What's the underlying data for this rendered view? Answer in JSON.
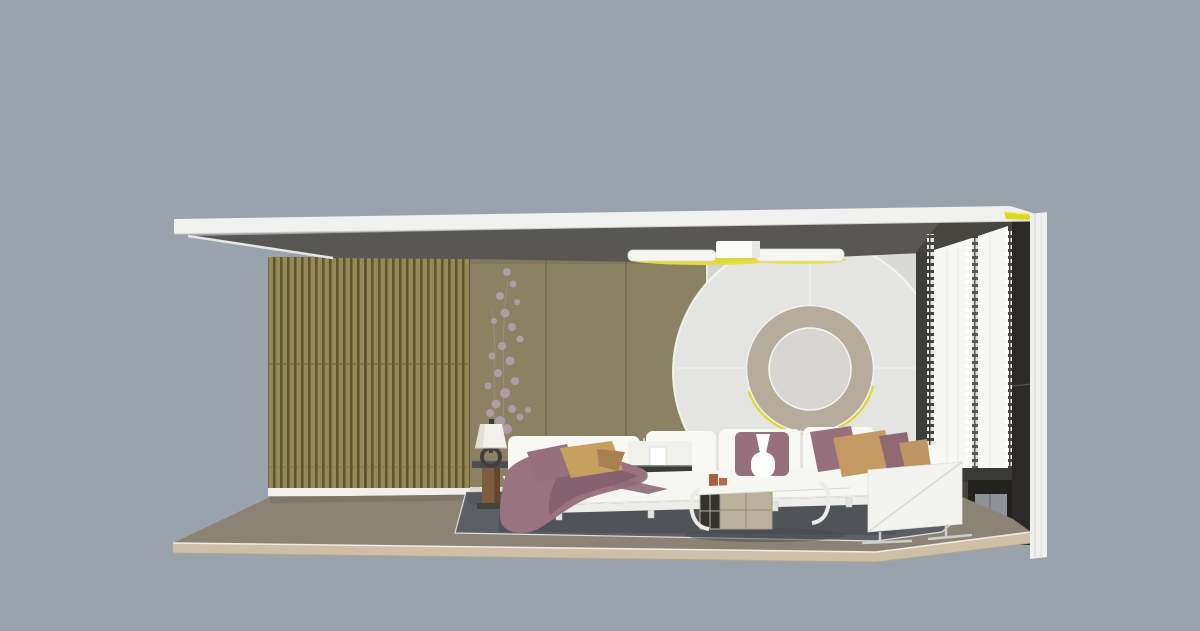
{
  "scene": {
    "title": "3D interior render - living room section cutaway",
    "background": "#9AA2AC",
    "objects": [
      "roof-slab",
      "ceiling-plane",
      "slat-wall",
      "panel-wall",
      "white-wall",
      "circle-feature-wall",
      "ring-niche",
      "ceiling-light",
      "sheer-curtains",
      "dark-window-wall",
      "window-glass",
      "right-frame",
      "floor-slab",
      "rug",
      "sectional-sofa",
      "throw-blanket",
      "pillows",
      "table-lamp",
      "side-table",
      "blossom-plant",
      "coffee-table",
      "storage-boxes",
      "media-cabinet"
    ]
  },
  "colors": {
    "background": "#9AA2AC",
    "roof": "#F1F1EF",
    "roof_accent_yellow": "#D8D922",
    "ceiling": "#585753",
    "slat_light": "#948A57",
    "slat_dark": "#5E5631",
    "panel_wall": "#8B8263",
    "white_wall": "#DADAD7",
    "disc": "#E4E4E2",
    "ring": "#B5AC9C",
    "ring_inner": "#D7D6D2",
    "ring_glow": "#DDD72E",
    "light_glow": "#E4DF39",
    "light_body": "#F5F5F1",
    "curtain_backdrop": "#46453F",
    "curtain_dark_strip": "#3E3D39",
    "curtain_sheer": "#F7F7F5",
    "dark_column": "#2B2A28",
    "window_glass": "#8E9196",
    "window_frame": "#23221F",
    "right_frame": "#F0F0EE",
    "baseboard": "#F0F0EC",
    "floor": "#8B8375",
    "floor_fascia": "#CDC0A7",
    "rug": "#5C5F64",
    "sofa_white": "#F8F8F5",
    "sofa_seat": "#F6F6F3",
    "pillow_mauve": "#97707D",
    "pillow_mustard": "#C5A05F",
    "pillow_tan": "#C39A63",
    "blanket": "#9A7380",
    "blanket_fold": "#84616E",
    "console_dark": "#3D3C39",
    "table_top": "#F6F6F3",
    "storage_box": "#B9B19B",
    "storage_dark": "#33322E",
    "vase_terracotta": "#A5643F",
    "lamp_shade": "#F2F0EA",
    "lamp_base": "#413F3B",
    "side_table_top": "#4B4F55",
    "side_table_wood": "#7D5D3E",
    "plant_blossom": "#B2A0AB",
    "cabinet_white": "#F3F3F0"
  }
}
